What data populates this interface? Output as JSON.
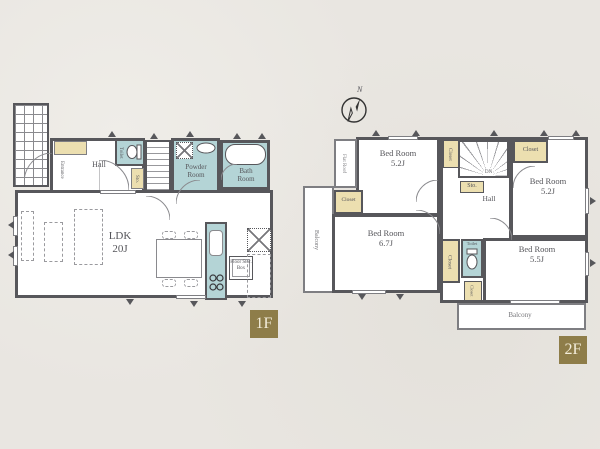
{
  "title": "Residential floor plan",
  "palette": {
    "background": "#e9e6e1",
    "wall": "#57575b",
    "wet_area": "#b4d4d6",
    "closet_fill": "#ecdfb0",
    "floor_tag_bg": "#8e7d49",
    "floor_tag_text": "#f3edda",
    "label_text": "#55555a"
  },
  "labels": {
    "closet": "Closet",
    "storage": "Sto.",
    "toilet": "Toilet",
    "hall": "Hall",
    "balcony": "Balcony"
  },
  "floor1": {
    "tag": "1F",
    "entrance": "Entrance",
    "hall": "Hall",
    "toilet": "Toilet",
    "ldk_name": "LDK",
    "ldk_size": "20J",
    "powder_room": "Powder Room",
    "bath_room": "Bath Room",
    "floor_storage": "Floor Stor. Box"
  },
  "floor2": {
    "tag": "2F",
    "compass_north": "N",
    "flat_roof": "Flat Roof",
    "stairs_down": "DN",
    "hall": "Hall",
    "bedrooms": [
      {
        "position": "top-left",
        "name": "Bed Room",
        "size": "5.2J"
      },
      {
        "position": "top-right",
        "name": "Bed Room",
        "size": "5.2J"
      },
      {
        "position": "bottom-left",
        "name": "Bed Room",
        "size": "6.7J"
      },
      {
        "position": "bottom-right",
        "name": "Bed Room",
        "size": "5.5J"
      }
    ]
  }
}
